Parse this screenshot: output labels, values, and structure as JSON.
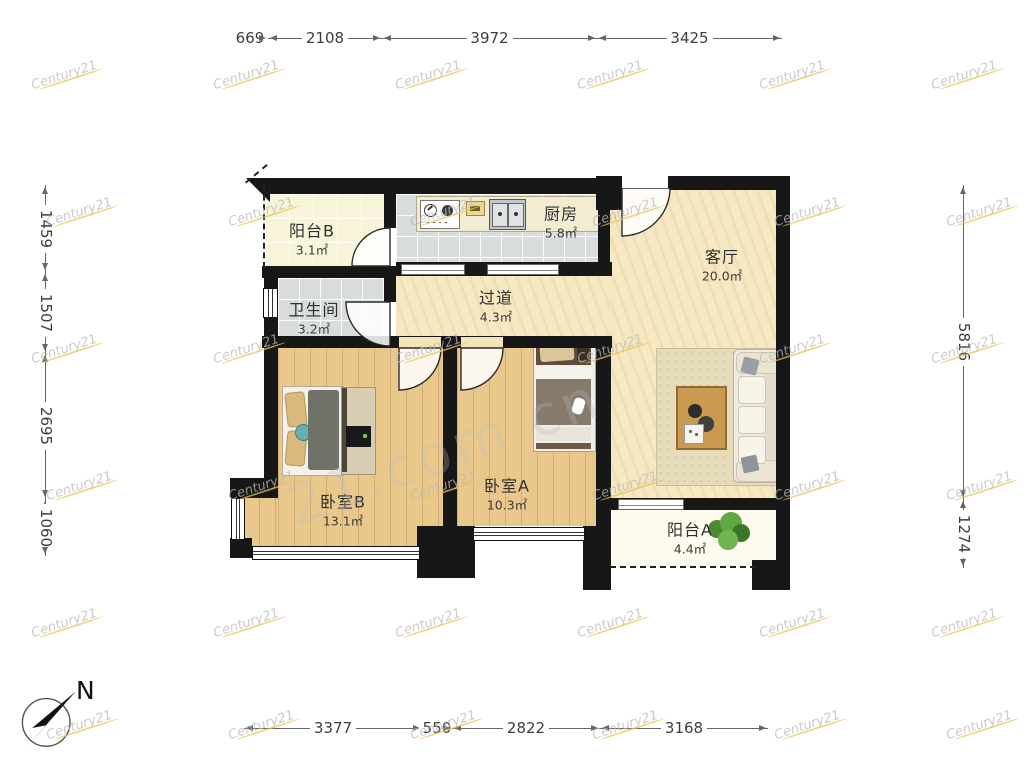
{
  "plan": {
    "rooms": [
      {
        "name": "阳台B",
        "area": "3.1㎡"
      },
      {
        "name": "厨房",
        "area": "5.8㎡"
      },
      {
        "name": "客厅",
        "area": "20.0㎡"
      },
      {
        "name": "卫生间",
        "area": "3.2㎡"
      },
      {
        "name": "过道",
        "area": "4.3㎡"
      },
      {
        "name": "卧室B",
        "area": "13.1㎡"
      },
      {
        "name": "卧室A",
        "area": "10.3㎡"
      },
      {
        "name": "阳台A",
        "area": "4.4㎡"
      }
    ]
  },
  "dimensions": {
    "top": [
      "669",
      "2108",
      "3972",
      "3425"
    ],
    "bottom": [
      "3377",
      "550",
      "2822",
      "3168"
    ],
    "left": [
      "1459",
      "1507",
      "2695",
      "1060"
    ],
    "right": [
      "5816",
      "1274"
    ]
  },
  "compass": {
    "label": "N"
  },
  "watermark": {
    "brand": "Century21",
    "large": "21.com.cn"
  },
  "colors": {
    "wall": "#171717",
    "wood_floor": "#eac88c",
    "tile_floor": "#d9dcdc",
    "marble_floor": "#f5e8c2",
    "balcony_b_floor": "#f8f4da",
    "balcony_a_floor": "#fdfbee",
    "dimension_line": "#666666",
    "watermark_swoosh": "#ebc350",
    "plant_green": "#4c8a33"
  }
}
